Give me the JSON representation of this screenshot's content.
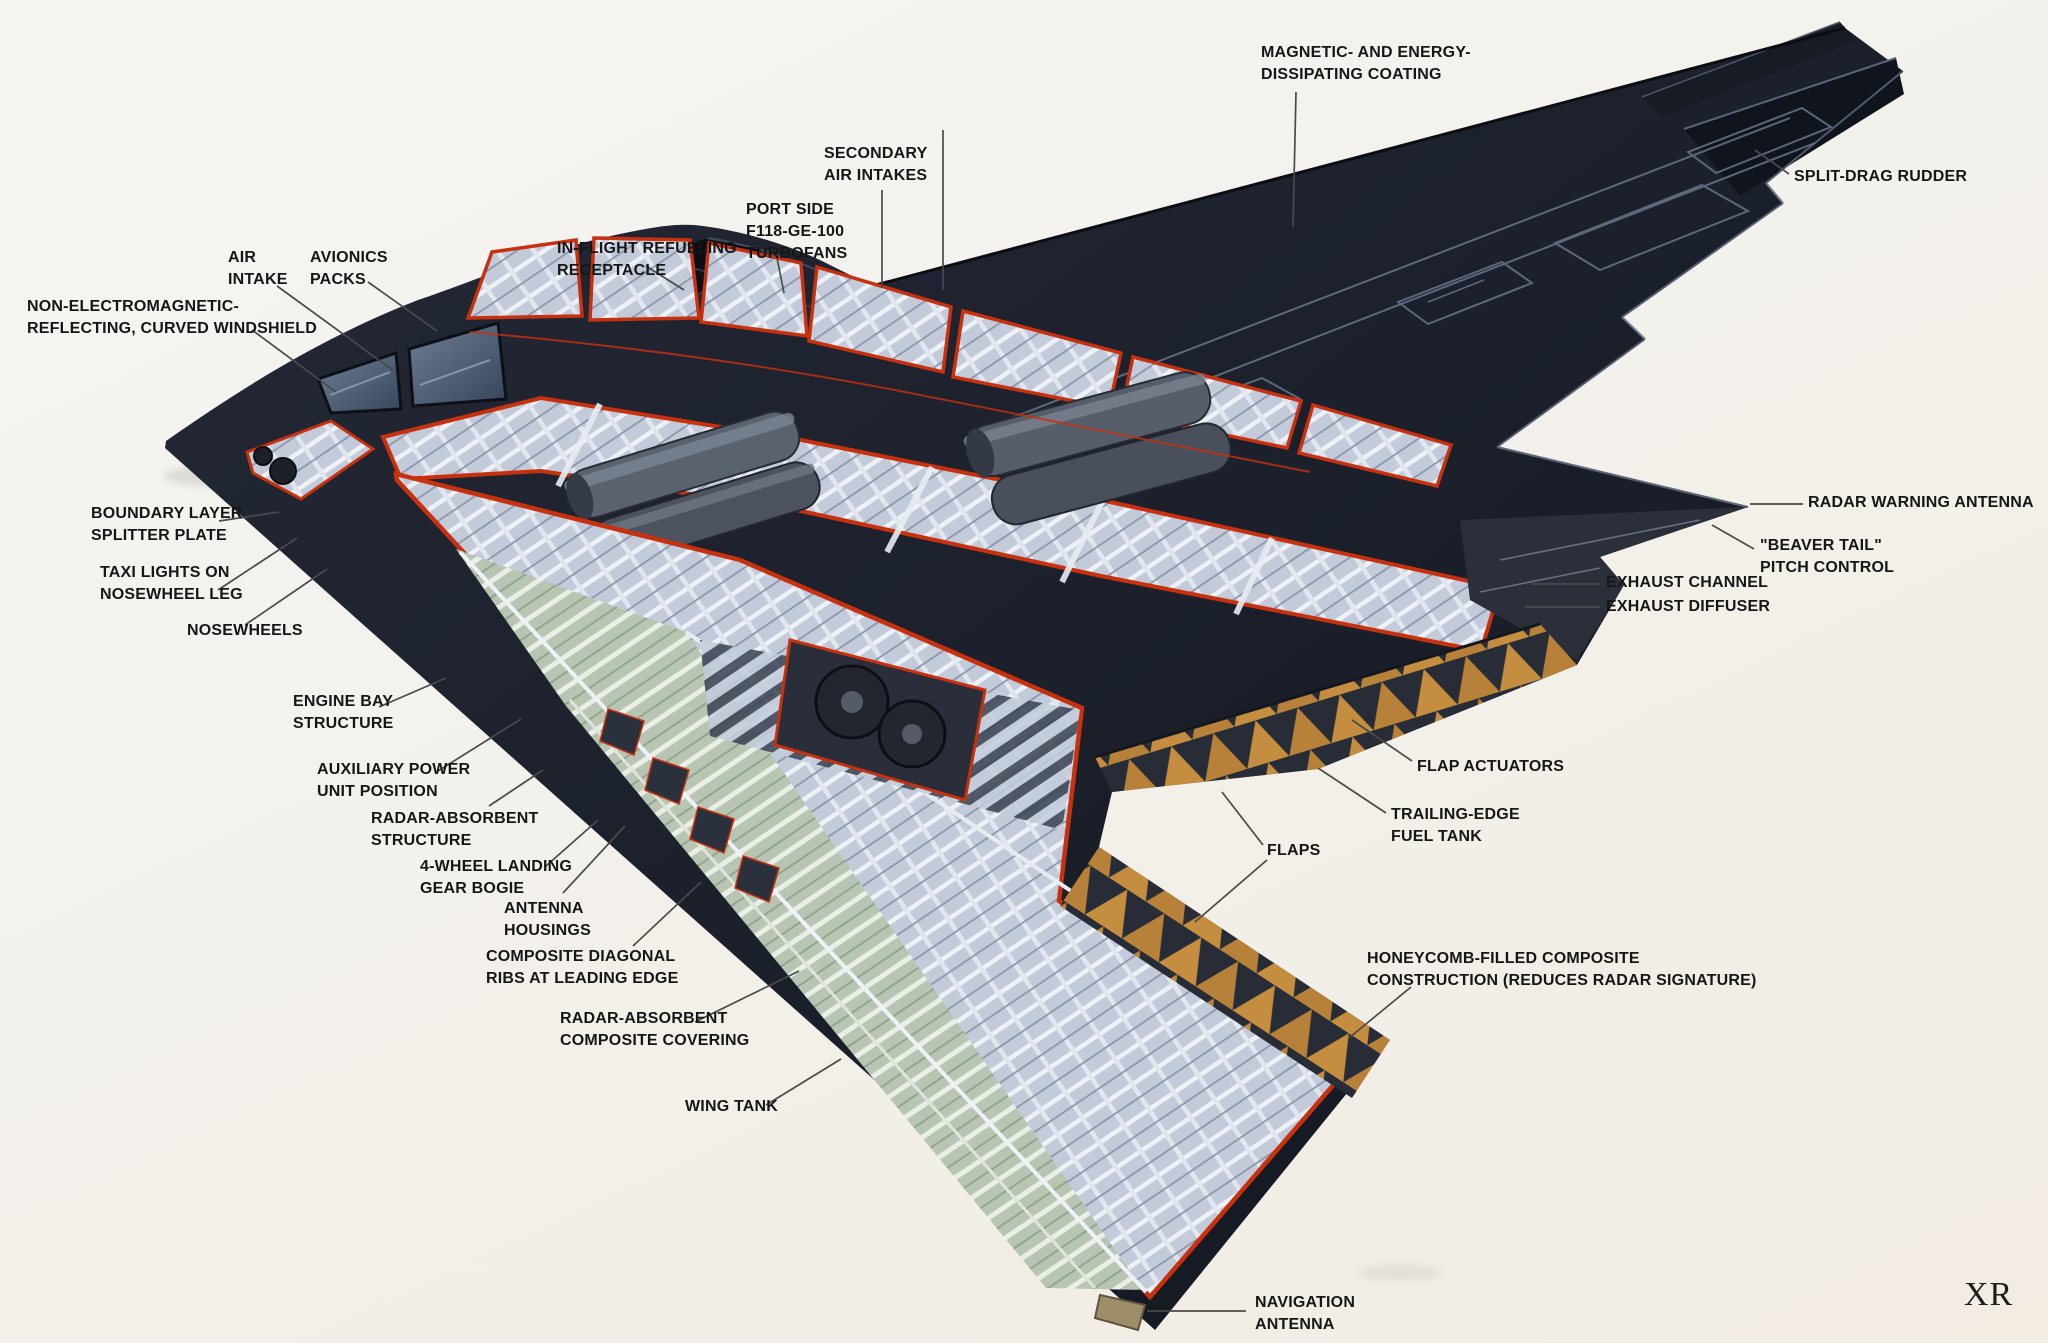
{
  "signature": "XR",
  "palette": {
    "background": "#f3f1ec",
    "body_dark": "#1b202b",
    "body_darker": "#10131b",
    "cut_line": "#c7310f",
    "structure_light": "#c7cedd",
    "structure_mid": "#9aa4b8",
    "fuel_tank_green": "#b9c5b3",
    "honeycomb_orange": "#c48d3f",
    "antenna_tan": "#9d8d68",
    "label_text": "#161616",
    "leader": "#4a4a48"
  },
  "labels": {
    "magnetic_coating": {
      "lines": [
        "MAGNETIC- AND ENERGY-",
        "DISSIPATING COATING"
      ]
    },
    "secondary_air_intakes": {
      "lines": [
        "SECONDARY",
        "AIR INTAKES"
      ]
    },
    "port_side_turbofans": {
      "lines": [
        "PORT SIDE",
        "F118-GE-100",
        "TURBOFANS"
      ]
    },
    "inflight_refueling": {
      "lines": [
        "IN-FLIGHT REFUELING",
        "RECEPTACLE"
      ]
    },
    "air_intake": {
      "lines": [
        "AIR",
        "INTAKE"
      ]
    },
    "avionics_packs": {
      "lines": [
        "AVIONICS",
        "PACKS"
      ]
    },
    "windshield": {
      "lines": [
        "NON-ELECTROMAGNETIC-",
        "REFLECTING, CURVED WINDSHIELD"
      ]
    },
    "split_drag_rudder": {
      "lines": [
        "SPLIT-DRAG RUDDER"
      ]
    },
    "radar_warning_antenna": {
      "lines": [
        "RADAR WARNING ANTENNA"
      ]
    },
    "beaver_tail": {
      "lines": [
        "\"BEAVER TAIL\"",
        "PITCH CONTROL"
      ]
    },
    "exhaust_channel": {
      "lines": [
        "EXHAUST CHANNEL"
      ]
    },
    "exhaust_diffuser": {
      "lines": [
        "EXHAUST DIFFUSER"
      ]
    },
    "flap_actuators": {
      "lines": [
        "FLAP ACTUATORS"
      ]
    },
    "trailing_edge_fuel_tank": {
      "lines": [
        "TRAILING-EDGE",
        "FUEL TANK"
      ]
    },
    "flaps": {
      "lines": [
        "FLAPS"
      ]
    },
    "honeycomb_construction": {
      "lines": [
        "HONEYCOMB-FILLED COMPOSITE",
        "CONSTRUCTION (REDUCES RADAR SIGNATURE)"
      ]
    },
    "navigation_antenna": {
      "lines": [
        "NAVIGATION",
        "ANTENNA"
      ]
    },
    "boundary_layer_splitter": {
      "lines": [
        "BOUNDARY LAYER",
        "SPLITTER PLATE"
      ]
    },
    "taxi_lights": {
      "lines": [
        "TAXI LIGHTS ON",
        "NOSEWHEEL LEG"
      ]
    },
    "nosewheels": {
      "lines": [
        "NOSEWHEELS"
      ]
    },
    "engine_bay_structure": {
      "lines": [
        "ENGINE BAY",
        "STRUCTURE"
      ]
    },
    "auxiliary_power_unit": {
      "lines": [
        "AUXILIARY POWER",
        "UNIT POSITION"
      ]
    },
    "radar_absorbent_structure": {
      "lines": [
        "RADAR-ABSORBENT",
        "STRUCTURE"
      ]
    },
    "landing_gear_bogie": {
      "lines": [
        "4-WHEEL LANDING",
        "GEAR BOGIE"
      ]
    },
    "antenna_housings": {
      "lines": [
        "ANTENNA",
        "HOUSINGS"
      ]
    },
    "composite_diagonal_ribs": {
      "lines": [
        "COMPOSITE DIAGONAL",
        "RIBS AT LEADING EDGE"
      ]
    },
    "radar_absorbent_covering": {
      "lines": [
        "RADAR-ABSORBENT",
        "COMPOSITE COVERING"
      ]
    },
    "wing_tank": {
      "lines": [
        "WING TANK"
      ]
    }
  }
}
